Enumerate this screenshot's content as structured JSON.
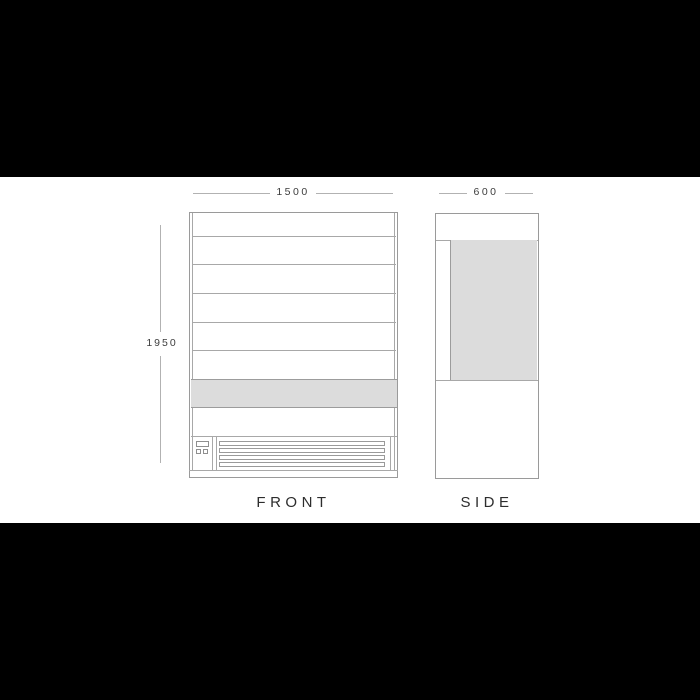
{
  "diagram_title": "refrigerated multideck display cabinet dimension drawing",
  "front_view": {
    "label": "FRONT",
    "width_dim": "1500",
    "height_dim": "1950",
    "shelf_line_count": 5,
    "grille_slat_count": 4
  },
  "side_view": {
    "label": "SIDE",
    "width_dim": "600"
  },
  "colors": {
    "letterbox": "#000000",
    "background": "#ffffff",
    "outline_stroke": "#9a9a9a",
    "dimension_stroke": "#b2b2b2",
    "dimension_text": "#3d3d3d",
    "caption_text": "#2d2d2d",
    "panel_fill": "#dcdcdc"
  }
}
